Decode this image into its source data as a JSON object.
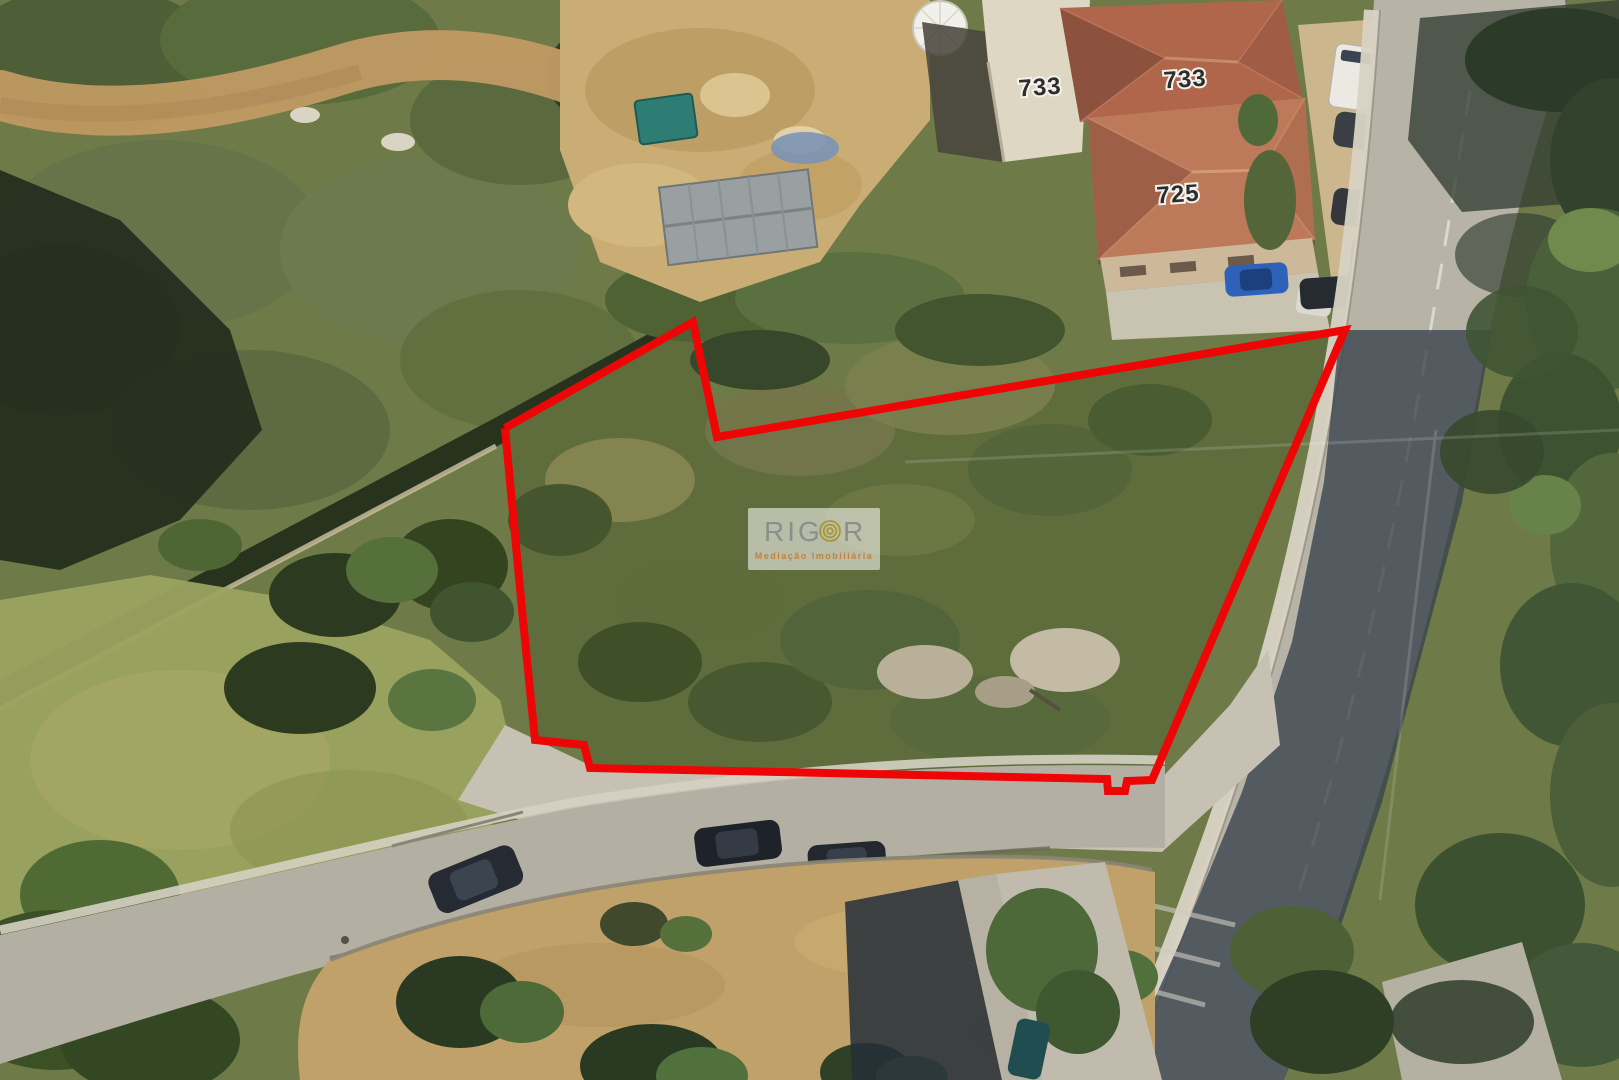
{
  "image": {
    "kind": "aerial-satellite-property-photo",
    "width_px": 1619,
    "height_px": 1080
  },
  "map_labels": [
    {
      "id": "house-number-white-building",
      "text": "733"
    },
    {
      "id": "house-number-roof-right",
      "text": "733"
    },
    {
      "id": "house-number-roof-lower",
      "text": "725"
    }
  ],
  "boundary": {
    "description": "red outline of the land plot for sale",
    "color": "#ee0505",
    "stroke_width": 8,
    "points": "505,428 693,322 717,437 1345,330 1152,780 1127,781 1125,791 1108,791 1107,779 590,768 584,745 535,740 523,620 505,428"
  },
  "watermark": {
    "brand_prefix": "RIG",
    "brand_suffix": "R",
    "tagline": "Mediação Imobiliária",
    "brand_color": "#83878a",
    "spiral_color": "#a8952f",
    "tagline_color": "#c07c35",
    "panel_color": "#ffffff"
  }
}
